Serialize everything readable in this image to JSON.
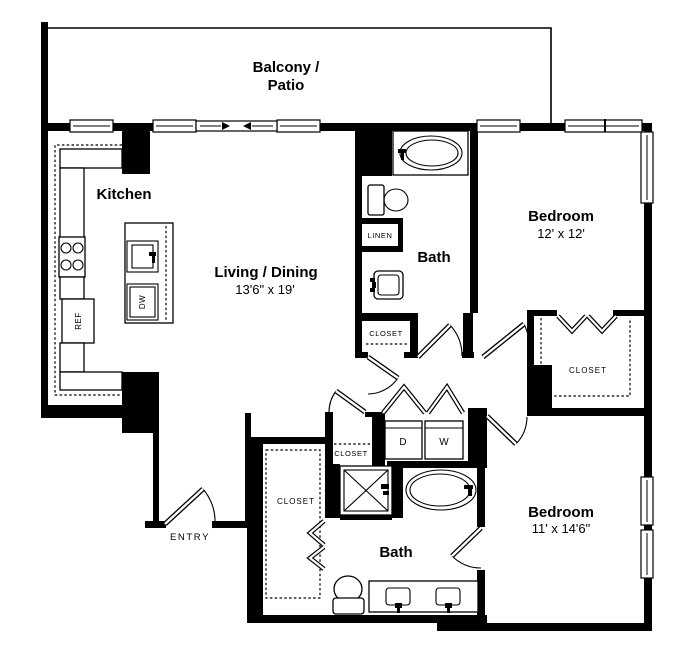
{
  "floorplan": {
    "balcony": {
      "label_line1": "Balcony /",
      "label_line2": "Patio"
    },
    "kitchen": {
      "label": "Kitchen"
    },
    "living_dining": {
      "label": "Living / Dining",
      "dimensions": "13'6\" x 19'"
    },
    "bath_upper": {
      "label": "Bath",
      "linen_label": "LINEN",
      "closet_label": "CLOSET"
    },
    "bedroom_upper": {
      "label": "Bedroom",
      "dimensions": "12' x 12'",
      "closet_label": "CLOSET"
    },
    "bath_lower": {
      "label": "Bath"
    },
    "bedroom_lower": {
      "label": "Bedroom",
      "dimensions": "11' x 14'6\""
    },
    "entry": {
      "label": "ENTRY"
    },
    "hall_closet": {
      "label": "CLOSET"
    },
    "walkin_closet": {
      "label": "CLOSET"
    },
    "laundry": {
      "dryer_label": "D",
      "washer_label": "W"
    },
    "kitchen_appliances": {
      "refrigerator_label": "REF",
      "dishwasher_label": "DW"
    },
    "colors": {
      "wall": "#000000",
      "background": "#ffffff"
    }
  }
}
